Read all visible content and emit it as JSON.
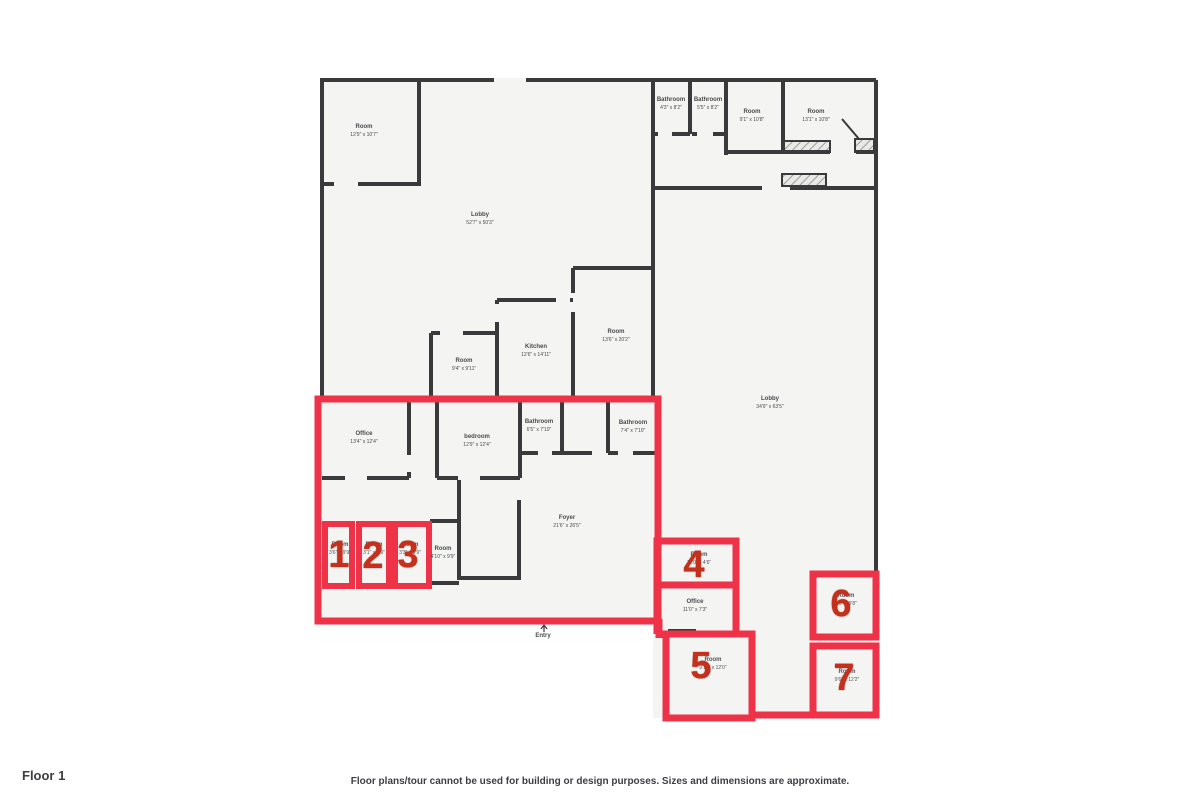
{
  "page": {
    "floor_label": "Floor 1",
    "disclaimer": "Floor plans/tour cannot be used for building or design purposes. Sizes and dimensions are approximate."
  },
  "colors": {
    "highlight_red": "#ee3248",
    "number_red": "#c5301c",
    "wall_gray": "#3a3a3c",
    "floor_fill": "#f4f4f3",
    "label_gray": "#4a4a4e"
  },
  "entry": {
    "label": "Entry"
  },
  "rooms": [
    {
      "name": "Room",
      "dims": "12'9\" x 10'7\""
    },
    {
      "name": "Lobby",
      "dims": "52'7\" x 50'3\""
    },
    {
      "name": "Bathroom",
      "dims": "4'3\" x 8'2\""
    },
    {
      "name": "Bathroom",
      "dims": "5'5\" x 8'2\""
    },
    {
      "name": "Room",
      "dims": "9'1\" x 10'8\""
    },
    {
      "name": "Room",
      "dims": "13'1\" x 10'8\""
    },
    {
      "name": "Room",
      "dims": "9'4\" x 9'11\""
    },
    {
      "name": "Kitchen",
      "dims": "12'6\" x 14'11\""
    },
    {
      "name": "Room",
      "dims": "13'6\" x 20'2\""
    },
    {
      "name": "Lobby",
      "dims": "34'9\" x 63'5\""
    },
    {
      "name": "Office",
      "dims": "13'4\" x 12'4\""
    },
    {
      "name": "bedroom",
      "dims": "12'9\" x 12'4\""
    },
    {
      "name": "Bathroom",
      "dims": "6'5\" x 7'10\""
    },
    {
      "name": "Bathroom",
      "dims": "7'4\" x 7'10\""
    },
    {
      "name": "Room",
      "dims": "4'10\" x 9'9\""
    },
    {
      "name": "Foyer",
      "dims": "21'6\" x 26'5\""
    },
    {
      "name": "Office",
      "dims": "11'0\" x 7'3\""
    }
  ],
  "zones": [
    {
      "number": "1",
      "name": "Room",
      "dims": "3'6\" x 9'9\""
    },
    {
      "number": "2",
      "name": "Room",
      "dims": "3'1\" x 9'9\""
    },
    {
      "number": "3",
      "name": "Room",
      "dims": "3'3\" x 9'9\""
    },
    {
      "number": "4",
      "name": "Room",
      "dims": "11'0\" x 4'6\""
    },
    {
      "number": "5",
      "name": "Room",
      "dims": "9'10\" x 12'0\""
    },
    {
      "number": "6",
      "name": "Room",
      "dims": "9'6\" x 9'8\""
    },
    {
      "number": "7",
      "name": "Room",
      "dims": "9'6\" x 12'2\""
    }
  ]
}
